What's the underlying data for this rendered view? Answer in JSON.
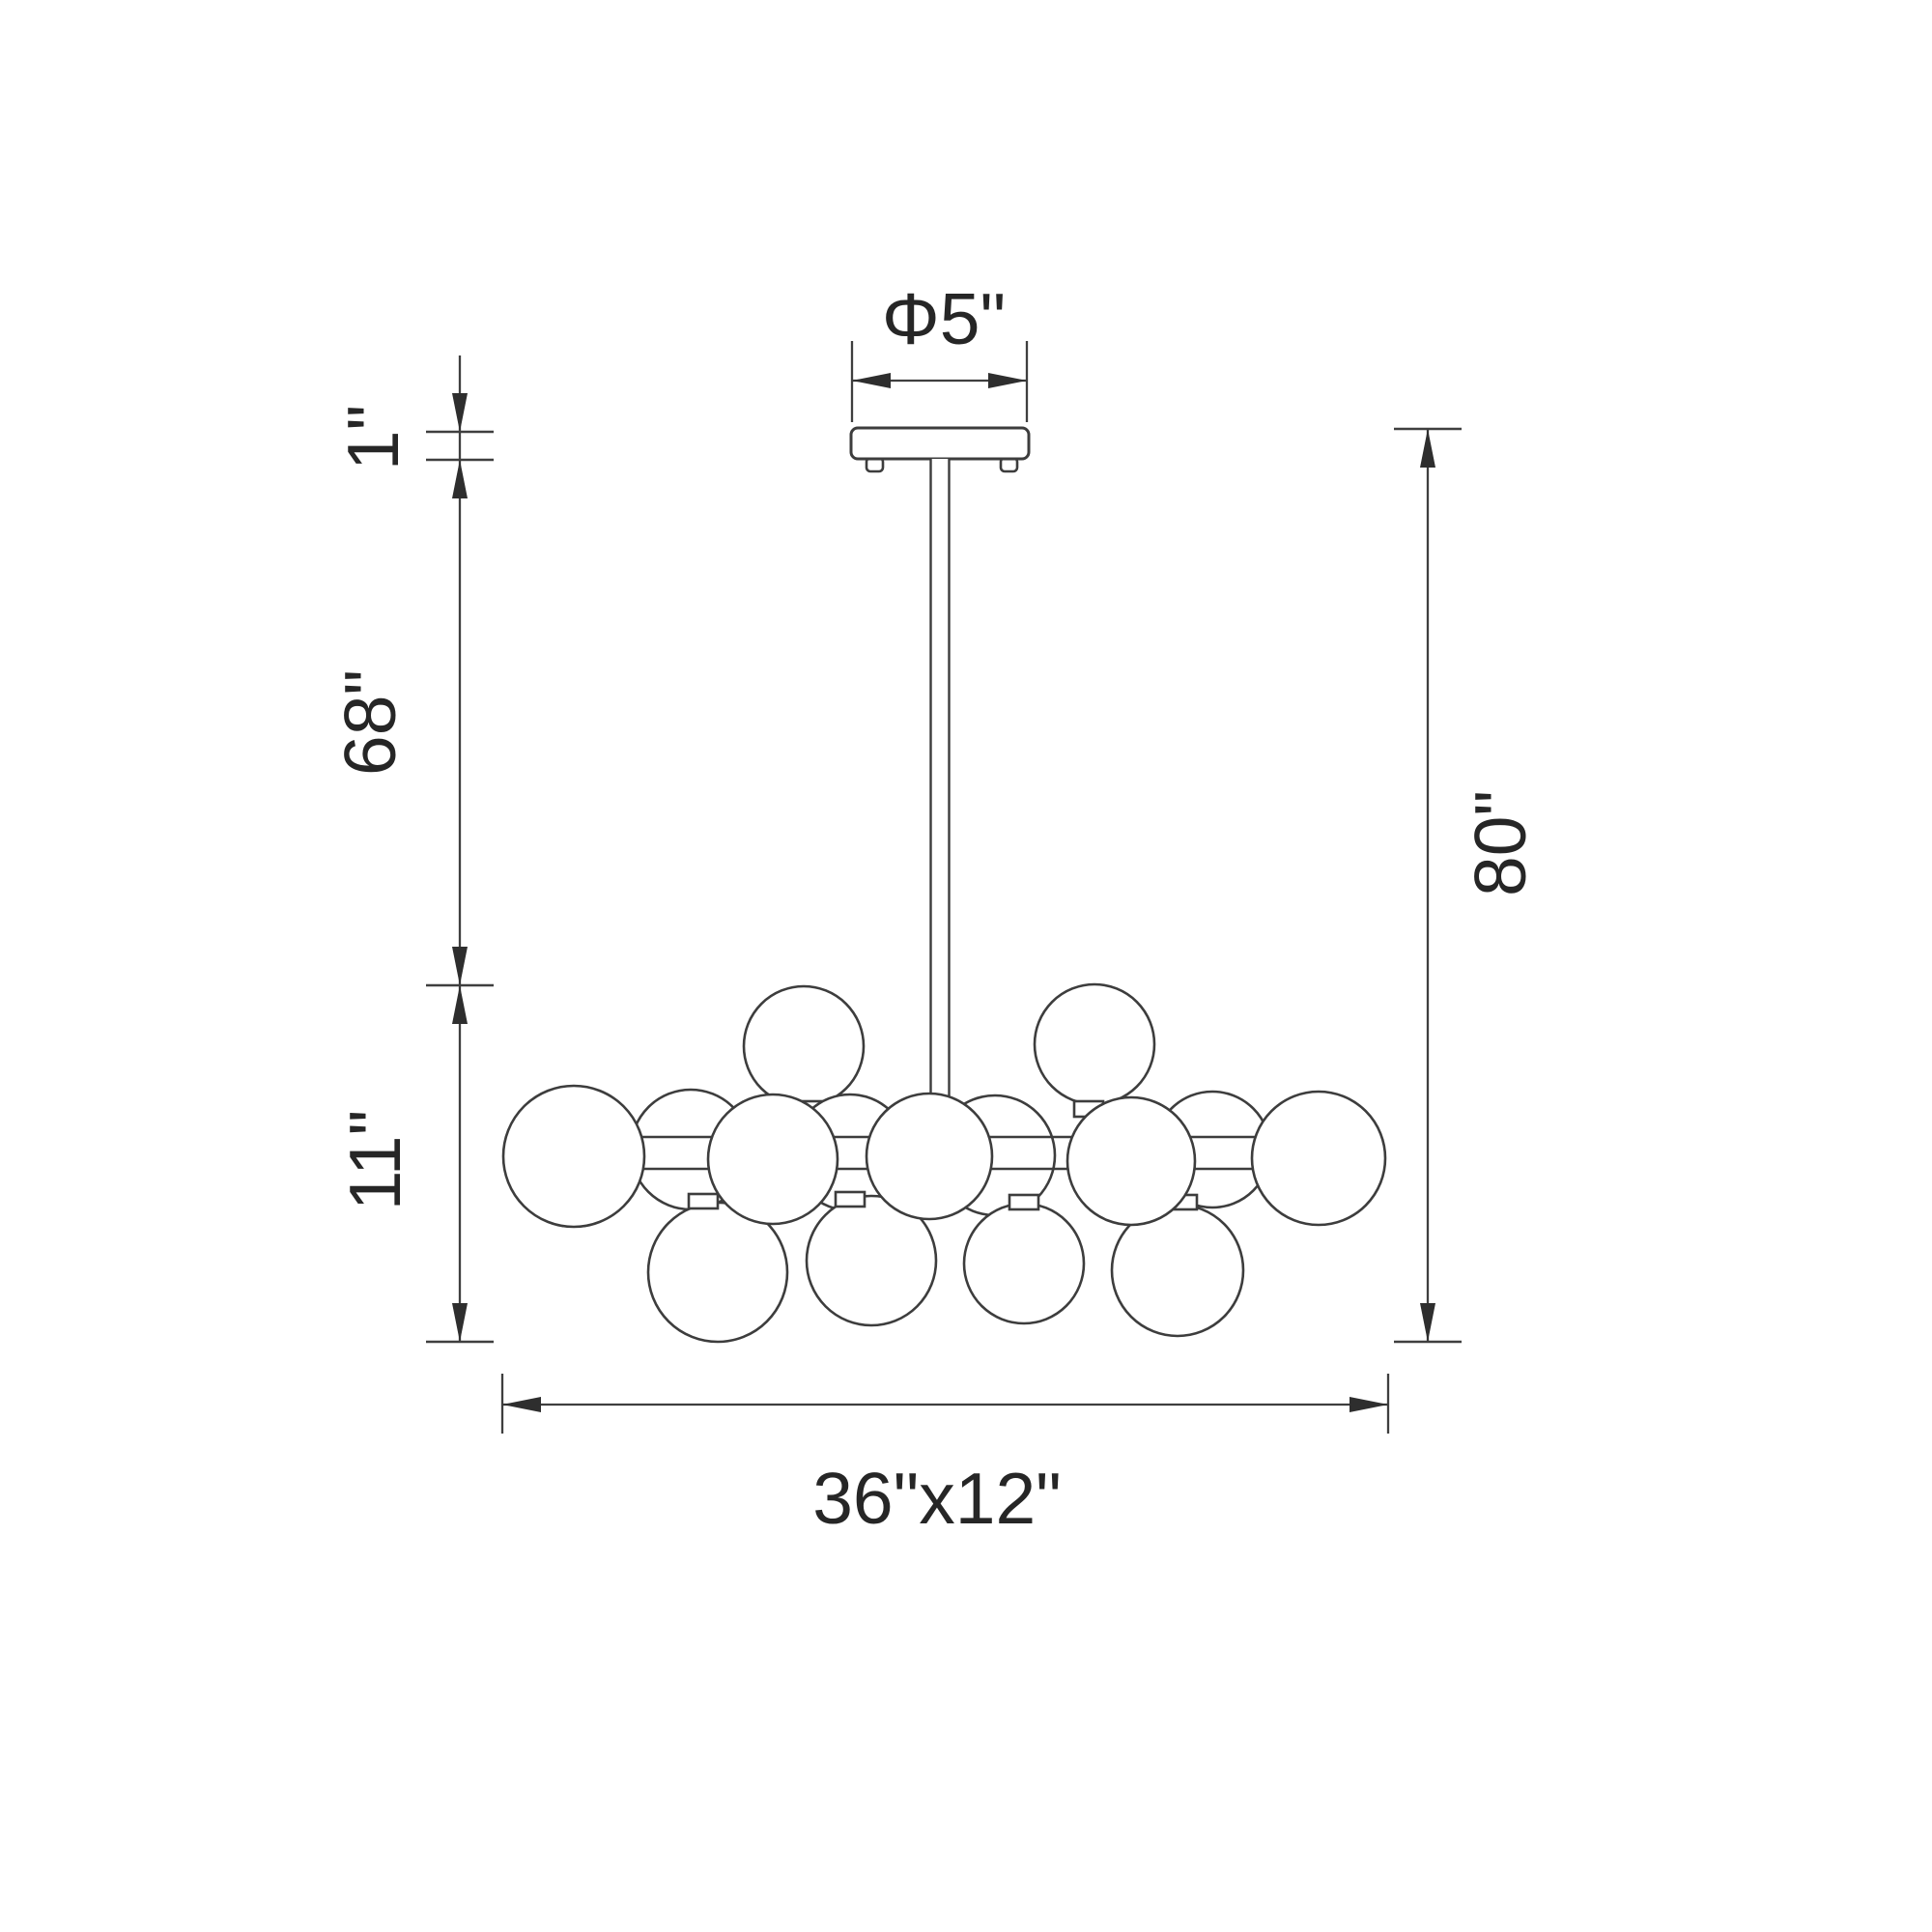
{
  "diagram": {
    "kind": "chandelier-dimension-drawing",
    "labels": {
      "canopy_diameter": "Φ5\"",
      "canopy_height": "1\"",
      "rod_length": "68\"",
      "body_height": "11\"",
      "overall_height": "80\"",
      "body_footprint": "36\"x12\""
    },
    "colors": {
      "background": "#ffffff",
      "line": "#3d3d3d",
      "text": "#262626"
    }
  }
}
